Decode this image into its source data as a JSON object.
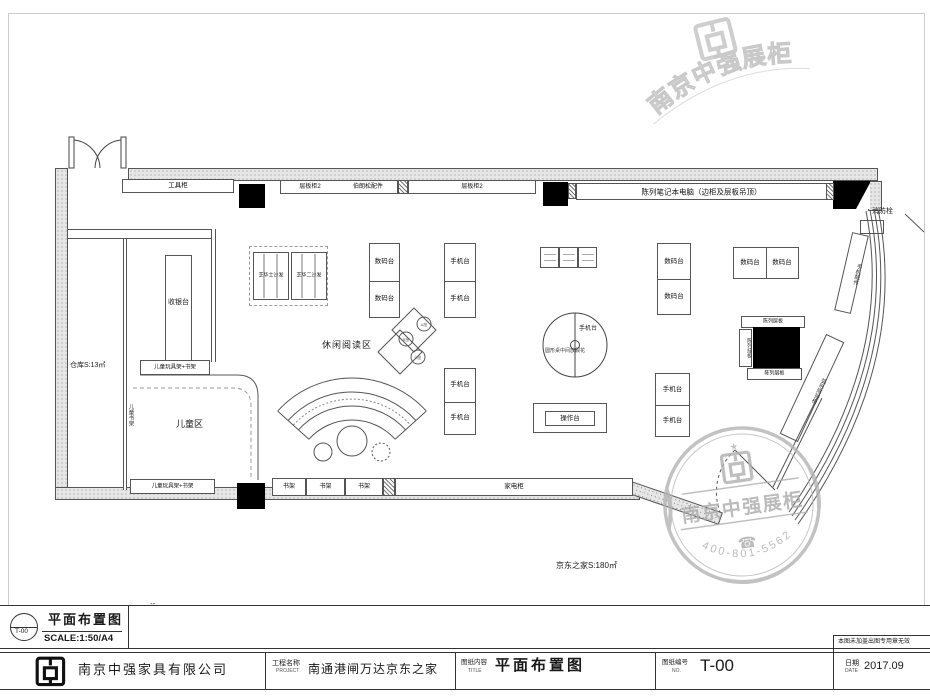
{
  "title_block": {
    "ref_code": "T-00",
    "ref_title": "平面布置图",
    "ref_scale": "SCALE:1:50/A4",
    "revision_dash": "--",
    "company_name": "南京中强家具有限公司",
    "project_label": "工程名称",
    "project_label_en": "PROJECT",
    "project_value": "南通港闸万达京东之家",
    "content_label": "图纸内容",
    "content_label_en": "TITLE",
    "content_value": "平面布置图",
    "number_label": "图纸编号",
    "number_label_en": "NO.",
    "number_value": "T-00",
    "date_label": "日期",
    "date_label_en": "DATE",
    "date_value": "2017.09",
    "validity_note": "本图未加盖出图专用章无效"
  },
  "plan": {
    "store_area": "京东之家S:180㎡",
    "warehouse": "仓库S:13㎡",
    "tool_cabinet": "工具柜",
    "shelf_cabinet2": "层板柜2",
    "accessories": "伯朗松配件",
    "laptop_display": "陈列笔记本电脑（边柜及层板吊顶）",
    "fire_hydrant": "消防栓",
    "cashier": "收银台",
    "sofa_left": "芝华士沙发",
    "sofa_right": "芝华二沙发",
    "digital_table": "数码台",
    "phone_table": "手机台",
    "operation_table": "操作台",
    "reading_area": "休闲阅读区",
    "round_table_note": "圆形桌中间放假花",
    "kids_area": "儿童区",
    "kids_shelf": "儿童玩具架+书架",
    "kids_bookshelf": "儿童书架",
    "bookshelf": "书架",
    "appliance_cabinet": "家电柜",
    "display_shelf": "陈列层板",
    "display_side": "陈列挂板",
    "curved_counter_upper": "手机配件",
    "curved_counter_lower": "弧形陈列柜",
    "seat_a": "A座",
    "seat_b": "B座",
    "seat_c": "C座"
  },
  "stamp": {
    "company": "南京中强展柜",
    "phone": "400-801-5562",
    "star": "★",
    "phone_icon": "☎"
  },
  "watermark": {
    "company": "南京中强展柜"
  }
}
